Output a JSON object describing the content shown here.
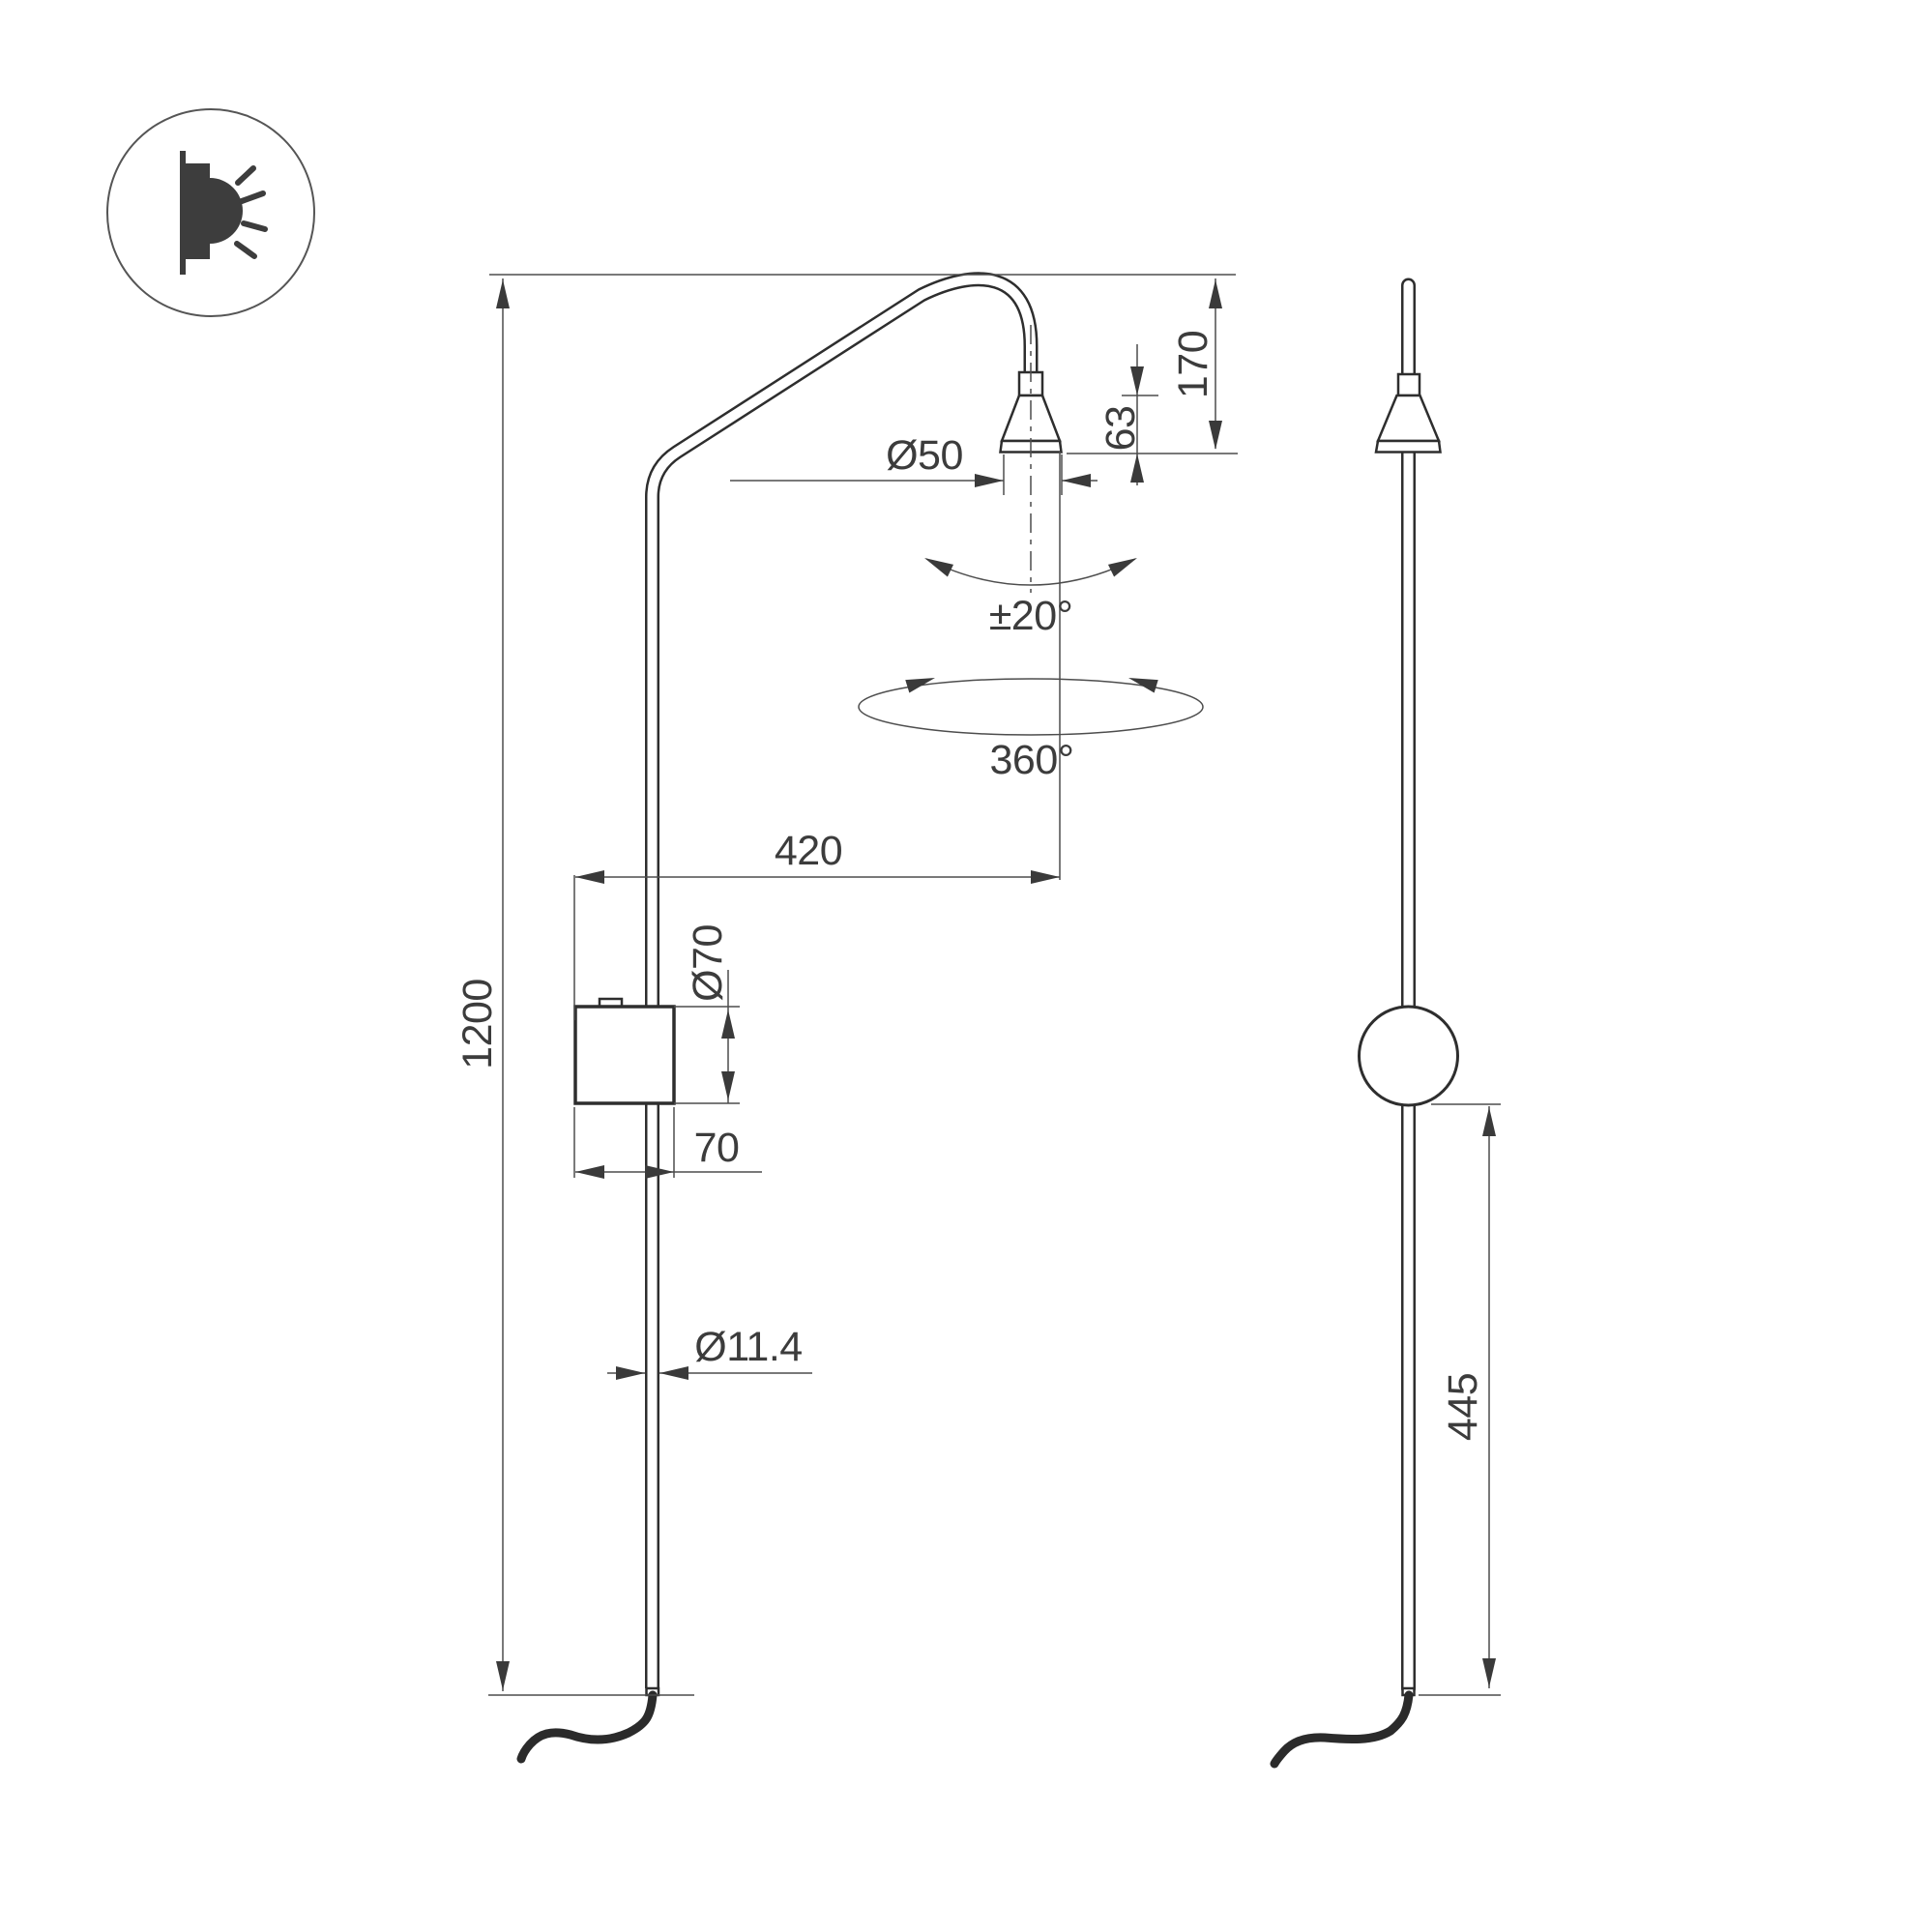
{
  "drawing": {
    "title": "wall-lamp-dimension-drawing",
    "icon": "wall-light-icon"
  },
  "dimensions": {
    "overall_height": "1200",
    "head_drop": "170",
    "head_height": "63",
    "head_diameter": "Ø50",
    "tilt_range": "±20°",
    "swivel_range": "360°",
    "arm_reach": "420",
    "canopy_diameter": "Ø70",
    "canopy_width": "70",
    "pole_diameter": "Ø11.4",
    "lower_section": "445"
  },
  "colors": {
    "line": "#2e2e2e",
    "thin_line": "#4d4d4d",
    "text": "#3c3c3c",
    "background": "#ffffff"
  }
}
